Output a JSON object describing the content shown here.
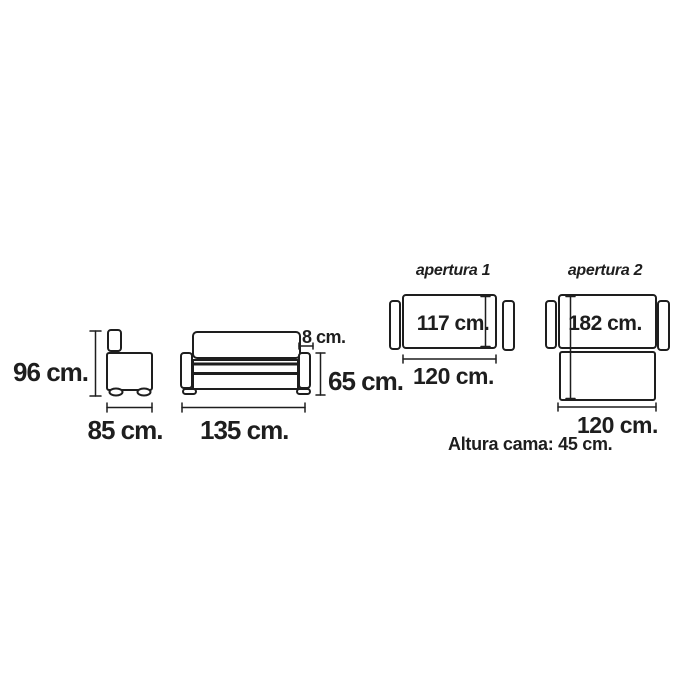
{
  "diagram": {
    "background_color": "#ffffff",
    "line_color": "#1e1e1e",
    "text_color": "#1e1e1e",
    "side_view": {
      "height_label": "96 cm.",
      "width_label": "85 cm."
    },
    "front_view": {
      "width_label": "135 cm.",
      "back_cushion_label": "8 cm.",
      "seat_height_label": "65 cm."
    },
    "apertura_1": {
      "title": "apertura 1",
      "mattress_length_label": "117 cm.",
      "bed_width_label": "120 cm."
    },
    "apertura_2": {
      "title": "apertura 2",
      "mattress_length_label": "182 cm.",
      "bed_width_label": "120 cm."
    },
    "note": "Altura cama: 45 cm."
  }
}
